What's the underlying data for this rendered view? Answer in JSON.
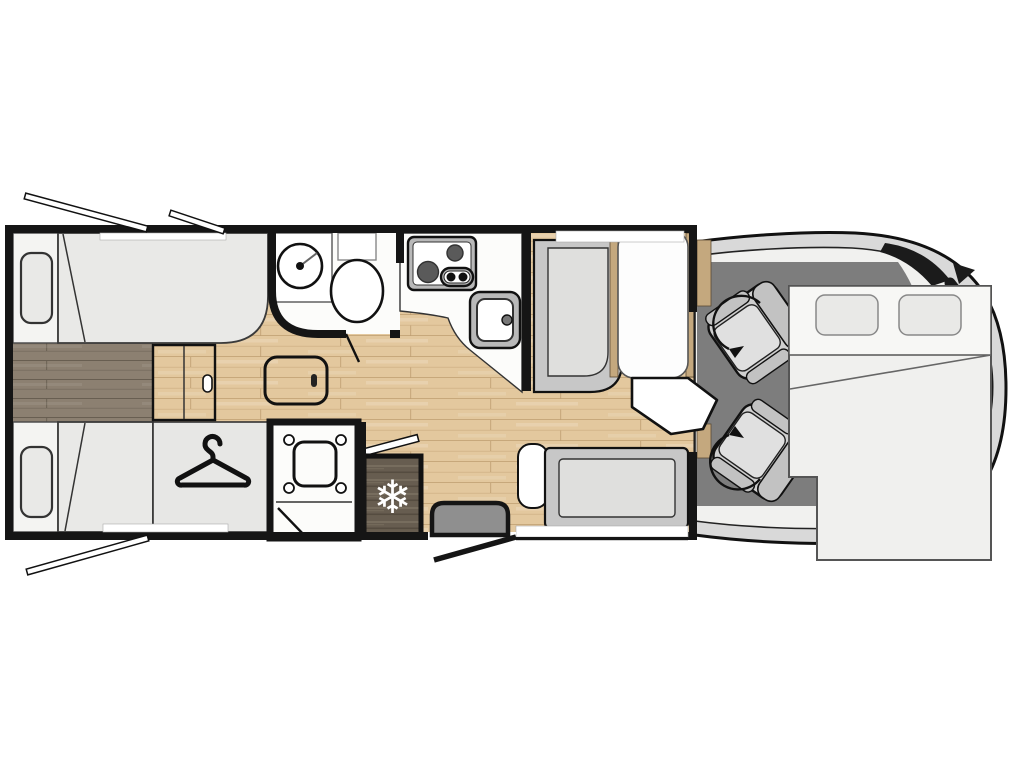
{
  "meta": {
    "title": "Motorhome floor plan",
    "view": "top-down"
  },
  "icons": {
    "snowflake": "❄",
    "hanger": "clothes-hanger",
    "swivel_arrow": "rotation-arrow"
  },
  "areas": {
    "rear_twin_beds": {
      "beds": 2,
      "pillows": 2,
      "walkway": "lowered dark-wood floor"
    },
    "wardrobe": {
      "icon": "hanger"
    },
    "bathroom": {
      "fixtures": [
        "round-washbasin",
        "toilet"
      ]
    },
    "shower": {
      "fixtures": [
        "shower-tray"
      ]
    },
    "kitchen": {
      "fixtures": [
        "two-burner-hob",
        "sink"
      ]
    },
    "refrigerator": {
      "icon": "snowflake"
    },
    "dinette": {
      "benches": 2,
      "table": 1,
      "table_flap": 1
    },
    "cab": {
      "swivel_seats": 2,
      "arrows": 2
    },
    "drop_down_bed": {
      "pillows": 2
    },
    "entry": {
      "step": 1,
      "open_door": 1
    },
    "open_windows": 3
  },
  "colors": {
    "background": "#ffffff",
    "wall": "#151515",
    "outline": "#111111",
    "floor_wood": "#e3c89e",
    "floor_seam": "#ab8758",
    "walkway": "#8c8071",
    "walkway_seam": "#544b40",
    "mattress": "#e9e9e7",
    "pillow": "#e9e9e7",
    "room_white": "#fcfcfa",
    "bench_frame": "#c7c7c7",
    "bench_cushion": "#dfdfdd",
    "appliance": "#b9b9b9",
    "burner": "#5a5a5a",
    "table_white": "#fdfdfd",
    "fridge_wood": "#675d50",
    "fridge_grain_light": "#857a6a",
    "fridge_grain_dark": "#463e33",
    "sideboard": "#c4a87e",
    "cab_body": "#d9d9d9",
    "cab_interior": "#f1f1ef",
    "cab_floor": "#7d7d7d",
    "glass": "#1b1b1b",
    "seat_frame": "#cfcfcf",
    "seat_back": "#c2c2c2",
    "seat_cushion": "#e0e0e0",
    "step_gray": "#8f8f8f",
    "bed_white": "#f0f0ee",
    "bed_band": "#f7f7f5"
  }
}
